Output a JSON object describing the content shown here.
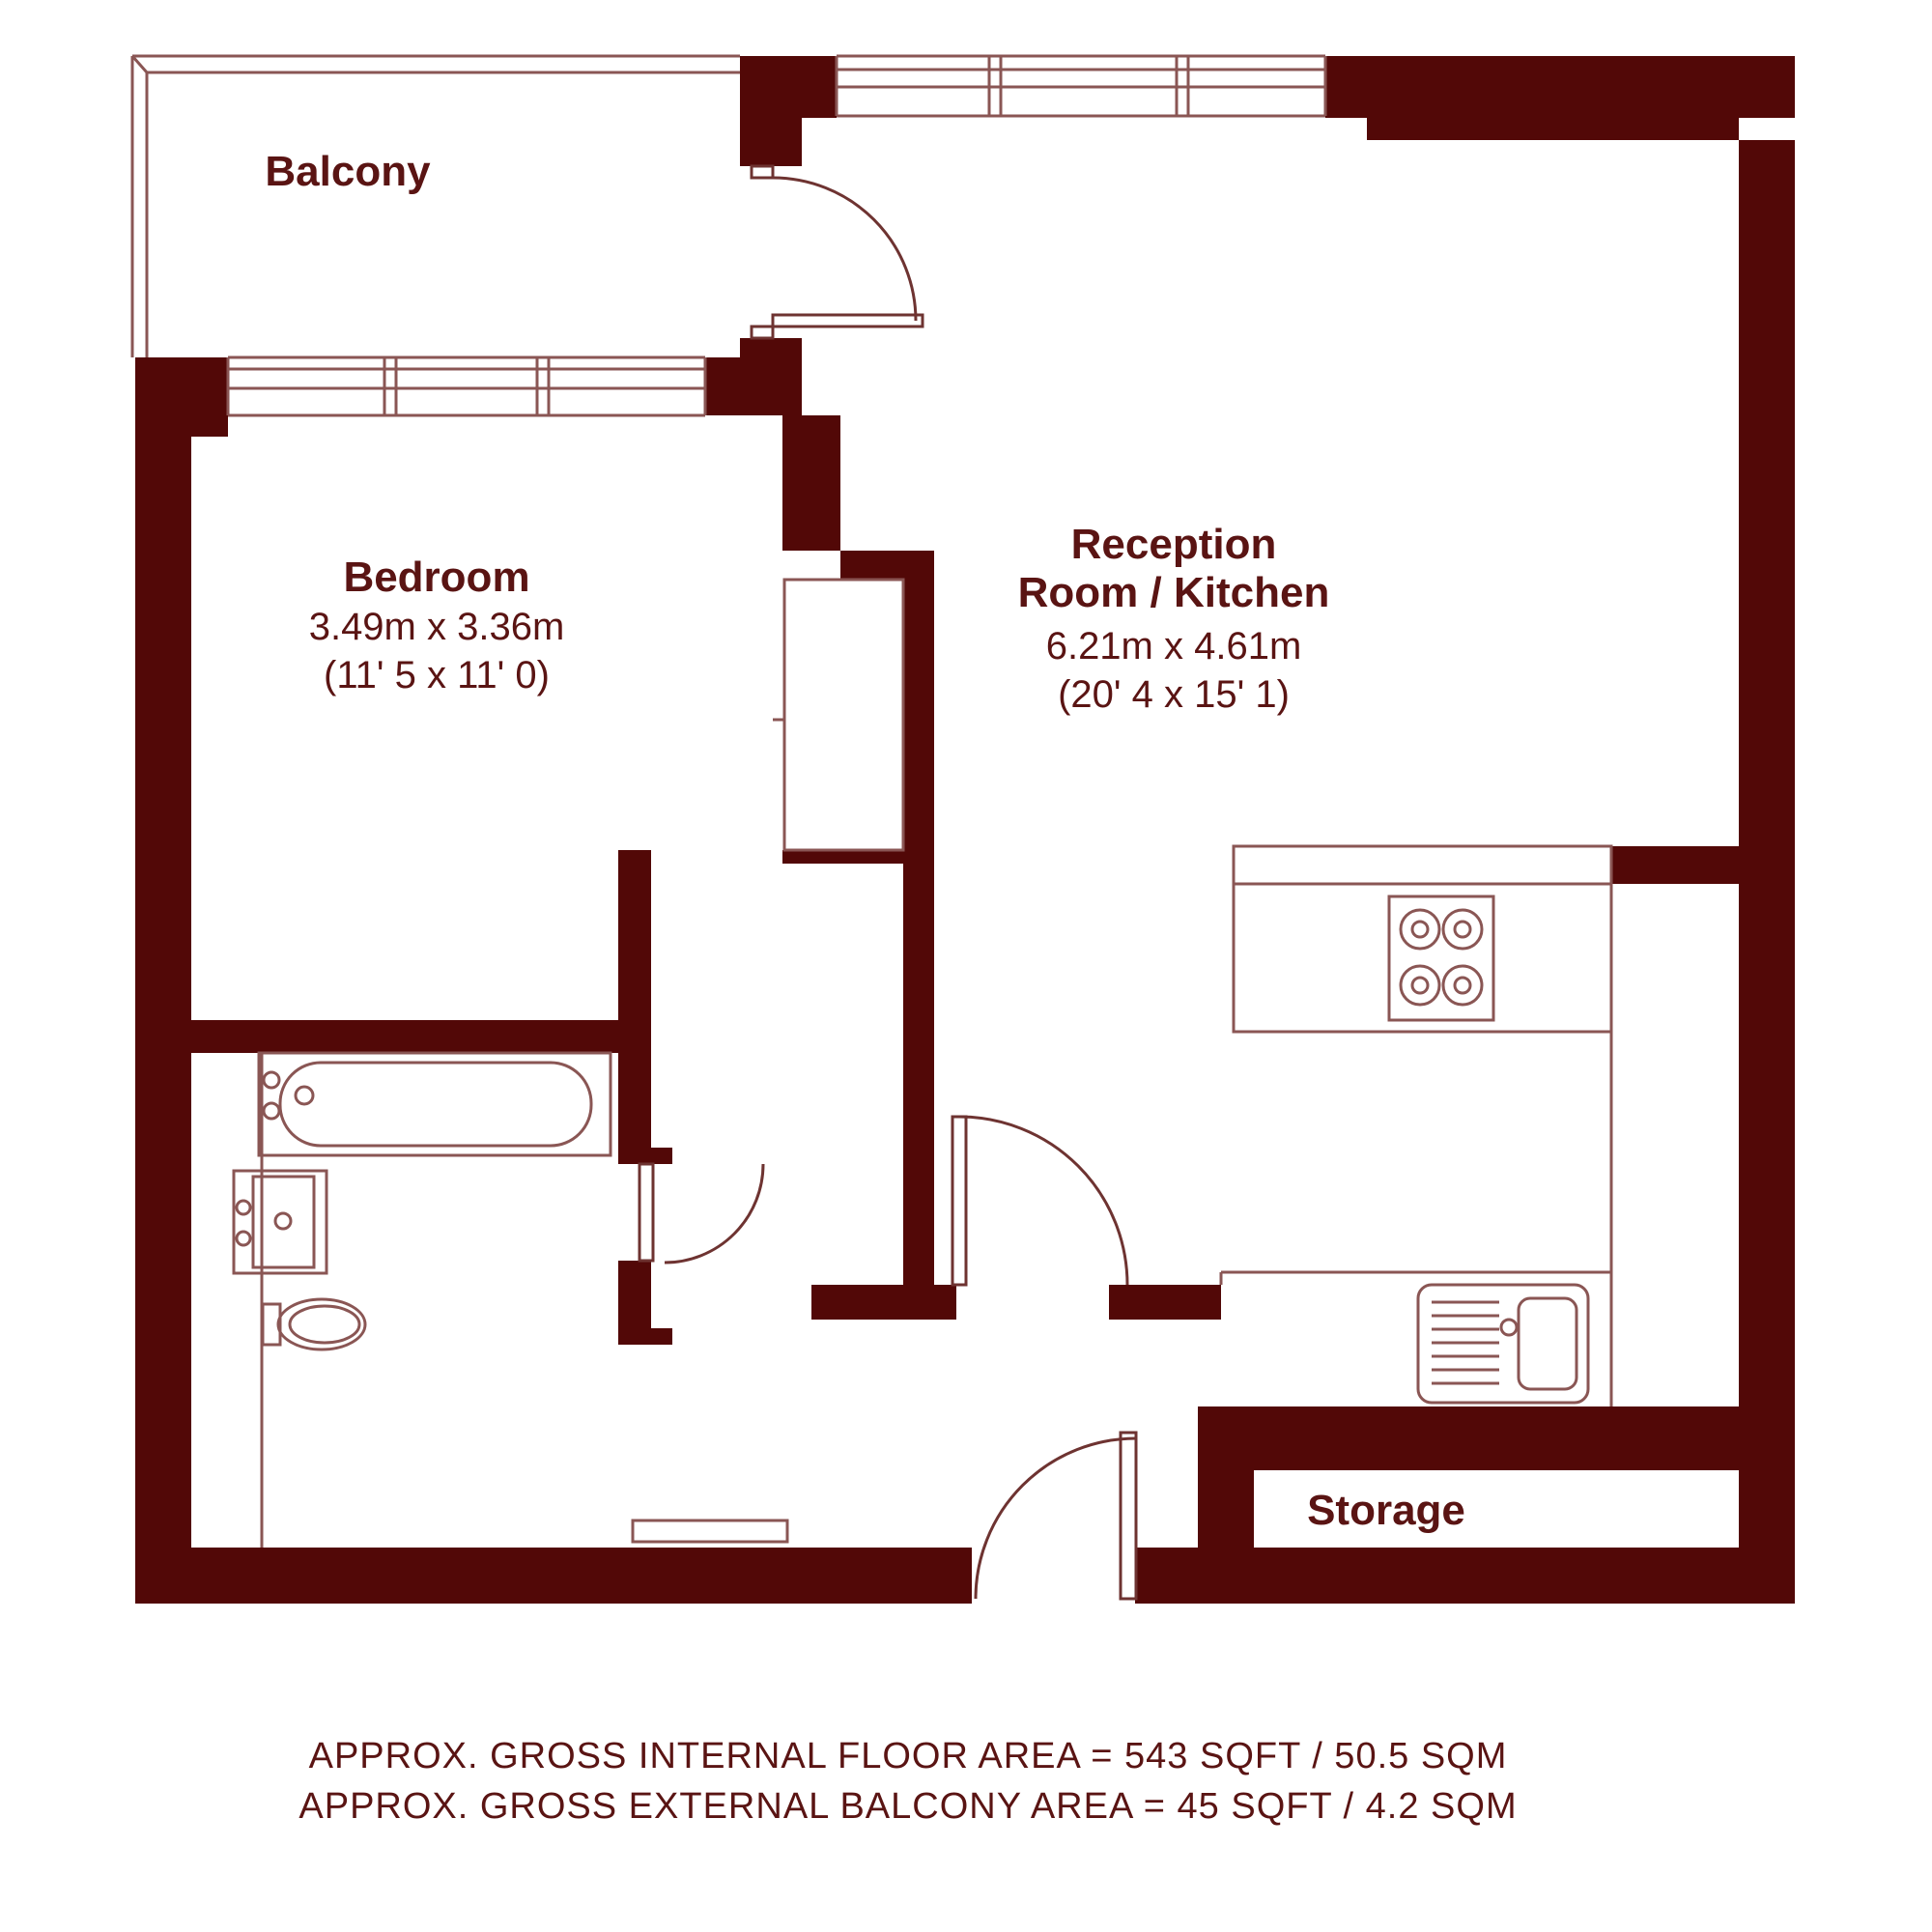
{
  "plan": {
    "type": "floor-plan",
    "rooms": {
      "balcony": {
        "label": "Balcony"
      },
      "bedroom": {
        "label": "Bedroom",
        "size_metric": "3.49m x 3.36m",
        "size_imperial": "(11' 5 x 11' 0)"
      },
      "reception": {
        "label_line1": "Reception",
        "label_line2": "Room / Kitchen",
        "size_metric": "6.21m x 4.61m",
        "size_imperial": "(20' 4 x 15' 1)"
      },
      "storage": {
        "label": "Storage"
      }
    },
    "footer": {
      "line1": "APPROX. GROSS INTERNAL FLOOR AREA = 543 SQFT / 50.5 SQM",
      "line2": "APPROX. GROSS EXTERNAL BALCONY AREA  = 45 SQFT / 4.2 SQM"
    },
    "colors": {
      "wall": "#520807",
      "line": "#8a5654",
      "door": "#6e3331",
      "text": "#5a1413",
      "background": "#ffffff"
    }
  }
}
